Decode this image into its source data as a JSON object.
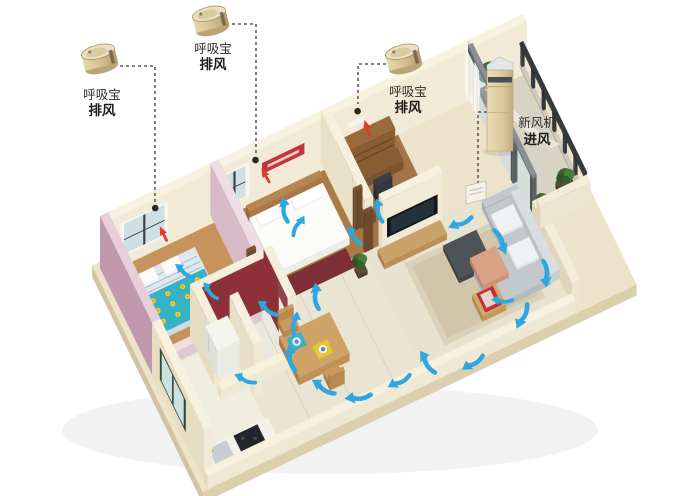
{
  "labels": {
    "breathing_device_1": {
      "line1": "呼吸宝",
      "line2": "排风"
    },
    "breathing_device_2": {
      "line1": "呼吸宝",
      "line2": "排风"
    },
    "breathing_device_3": {
      "line1": "呼吸宝",
      "line2": "排风"
    },
    "fresh_air_unit": {
      "line1": "新风机",
      "line2": "进风"
    }
  },
  "icons": {
    "breathing_vent_device": "small gold cylinder exhaust fan",
    "fresh_air_tower": "tall champagne floor-standing fresh air machine",
    "airflow_arrow": "blue curved swoosh arrow",
    "exhaust_arrow": "small red arrow toward ceiling vent",
    "vent_dot": "dark round wall vent"
  },
  "colors": {
    "background": "#ffffff",
    "flow_arrow": "#2ea7e0",
    "exhaust_arrow": "#e23a28",
    "wall_cream": "#f1ead6",
    "wall_pink": "#c09aac",
    "bathroom_red": "#8e3038",
    "device_gold": "#d8c49c",
    "leader_line": "#3a3a3a"
  }
}
